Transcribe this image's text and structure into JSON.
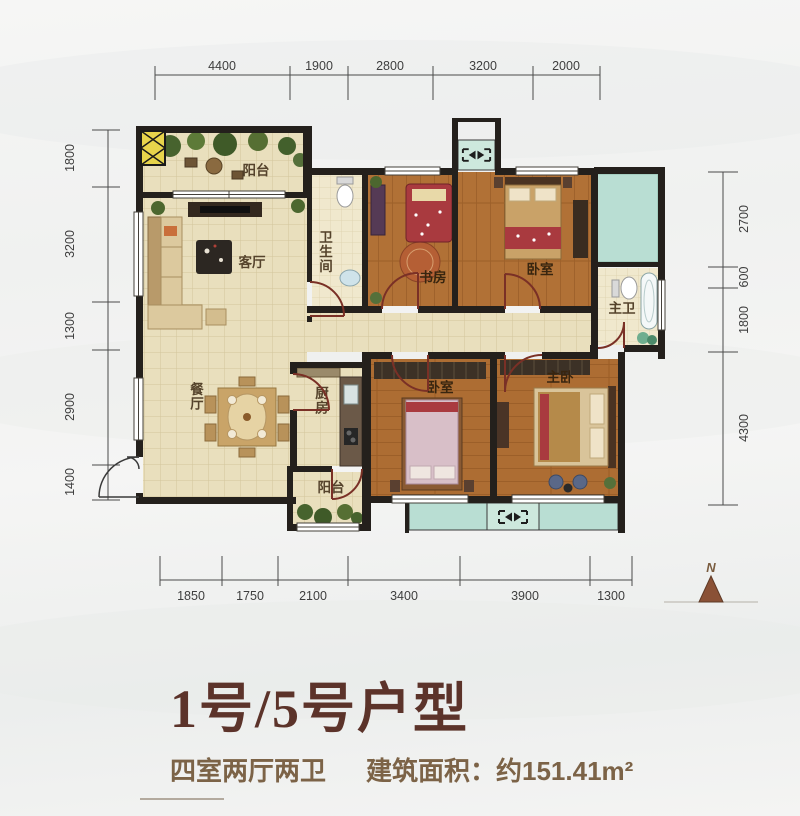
{
  "title": {
    "main": "1号/5号户型",
    "spec": "四室两厅两卫",
    "area_label": "建筑面积：约151.41m²"
  },
  "compass": {
    "label": "N"
  },
  "rooms": {
    "balcony_top": "阳台",
    "living": "客厅",
    "dining": "餐厅",
    "bathroom": "卫生间",
    "study": "书房",
    "bedroom_top": "卧室",
    "master_bath": "主卫",
    "kitchen": "厨房",
    "balcony_kitchen": "阳台",
    "bedroom_bottom": "卧室",
    "master_bedroom": "主卧"
  },
  "dimensions": {
    "top": [
      "4400",
      "1900",
      "2800",
      "3200",
      "2000"
    ],
    "left": [
      "1800",
      "3200",
      "1300",
      "2900",
      "1400"
    ],
    "right": [
      "2700",
      "600",
      "1800",
      "4300"
    ],
    "bottom": [
      "1850",
      "1750",
      "2100",
      "3400",
      "3900",
      "1300"
    ]
  },
  "colors": {
    "wall": "#24201c",
    "tile_floor": "#e9dfbd",
    "wood_floor": "#b07035",
    "outdoor_teal": "#b9ded3",
    "shaft_yellow": "#e7d44b",
    "door_arc": "#7a3026",
    "title_text": "#5c332a",
    "subtitle_text": "#7c6347"
  }
}
